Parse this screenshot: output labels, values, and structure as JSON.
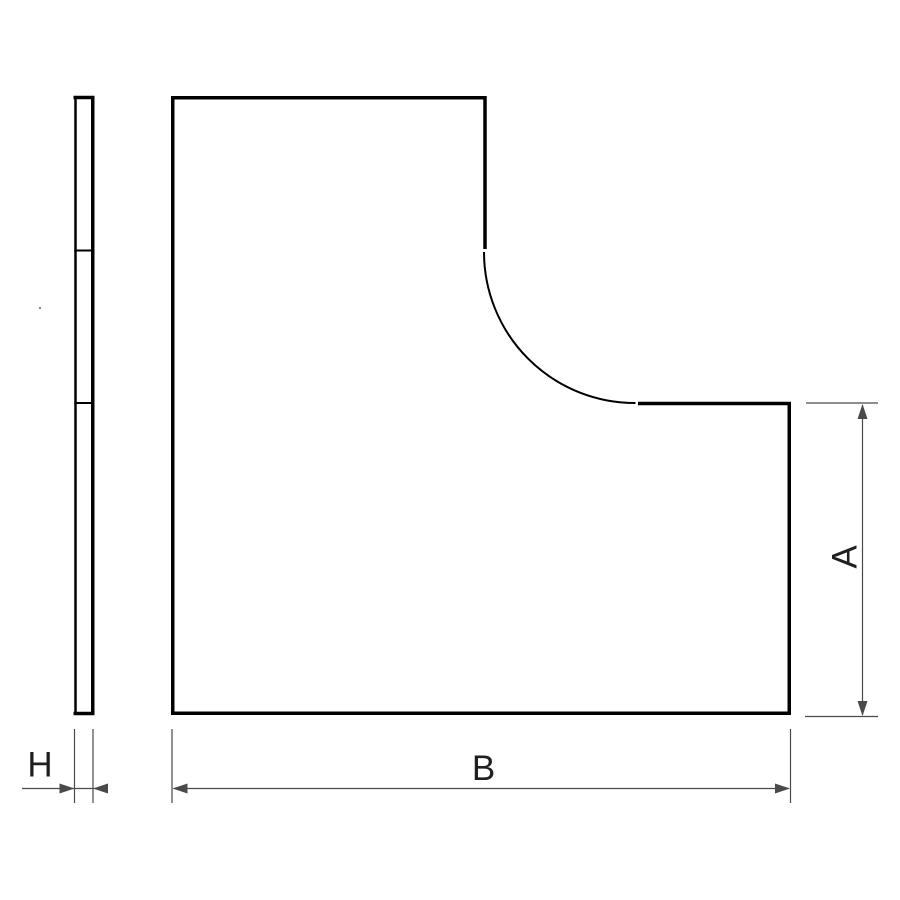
{
  "drawing": {
    "labels": {
      "side_height": "A",
      "bottom_width": "B",
      "thickness": "H"
    },
    "colors": {
      "background": "#ffffff",
      "outline": "#000000",
      "dimension": "#4a4a4a",
      "text": "#1f1f1f"
    }
  }
}
